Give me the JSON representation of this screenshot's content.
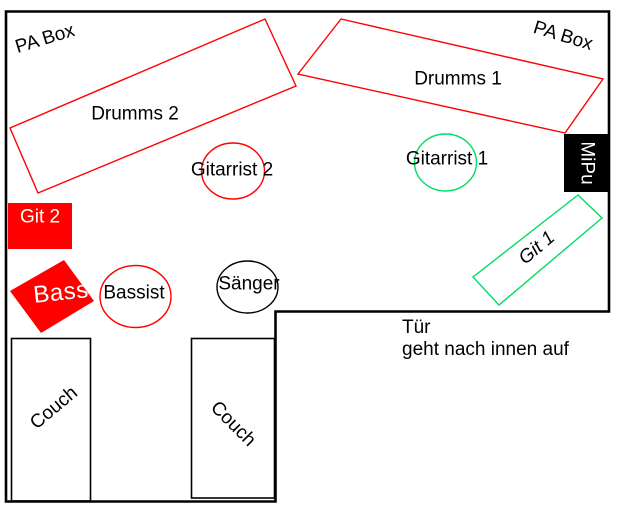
{
  "diagram": {
    "title": "band-rehearsal-room-floor-plan",
    "labels": {
      "pa_box_left": "PA Box",
      "pa_box_right": "PA Box",
      "drums_2": "Drumms 2",
      "drums_1": "Drumms 1",
      "guitarist_2": "Gitarrist 2",
      "guitarist_1": "Gitarrist 1",
      "mipu": "MiPu",
      "git_1": "Git 1",
      "git_2": "Git 2",
      "bass": "Bass",
      "bassist": "Bassist",
      "singer": "Sänger",
      "door_line1": "Tür",
      "door_line2": "geht nach innen auf",
      "couch_left": "Couch",
      "couch_right": "Couch"
    },
    "colors": {
      "red": "#ff0000",
      "green": "#00dc64",
      "black": "#000000",
      "white": "#ffffff"
    }
  }
}
